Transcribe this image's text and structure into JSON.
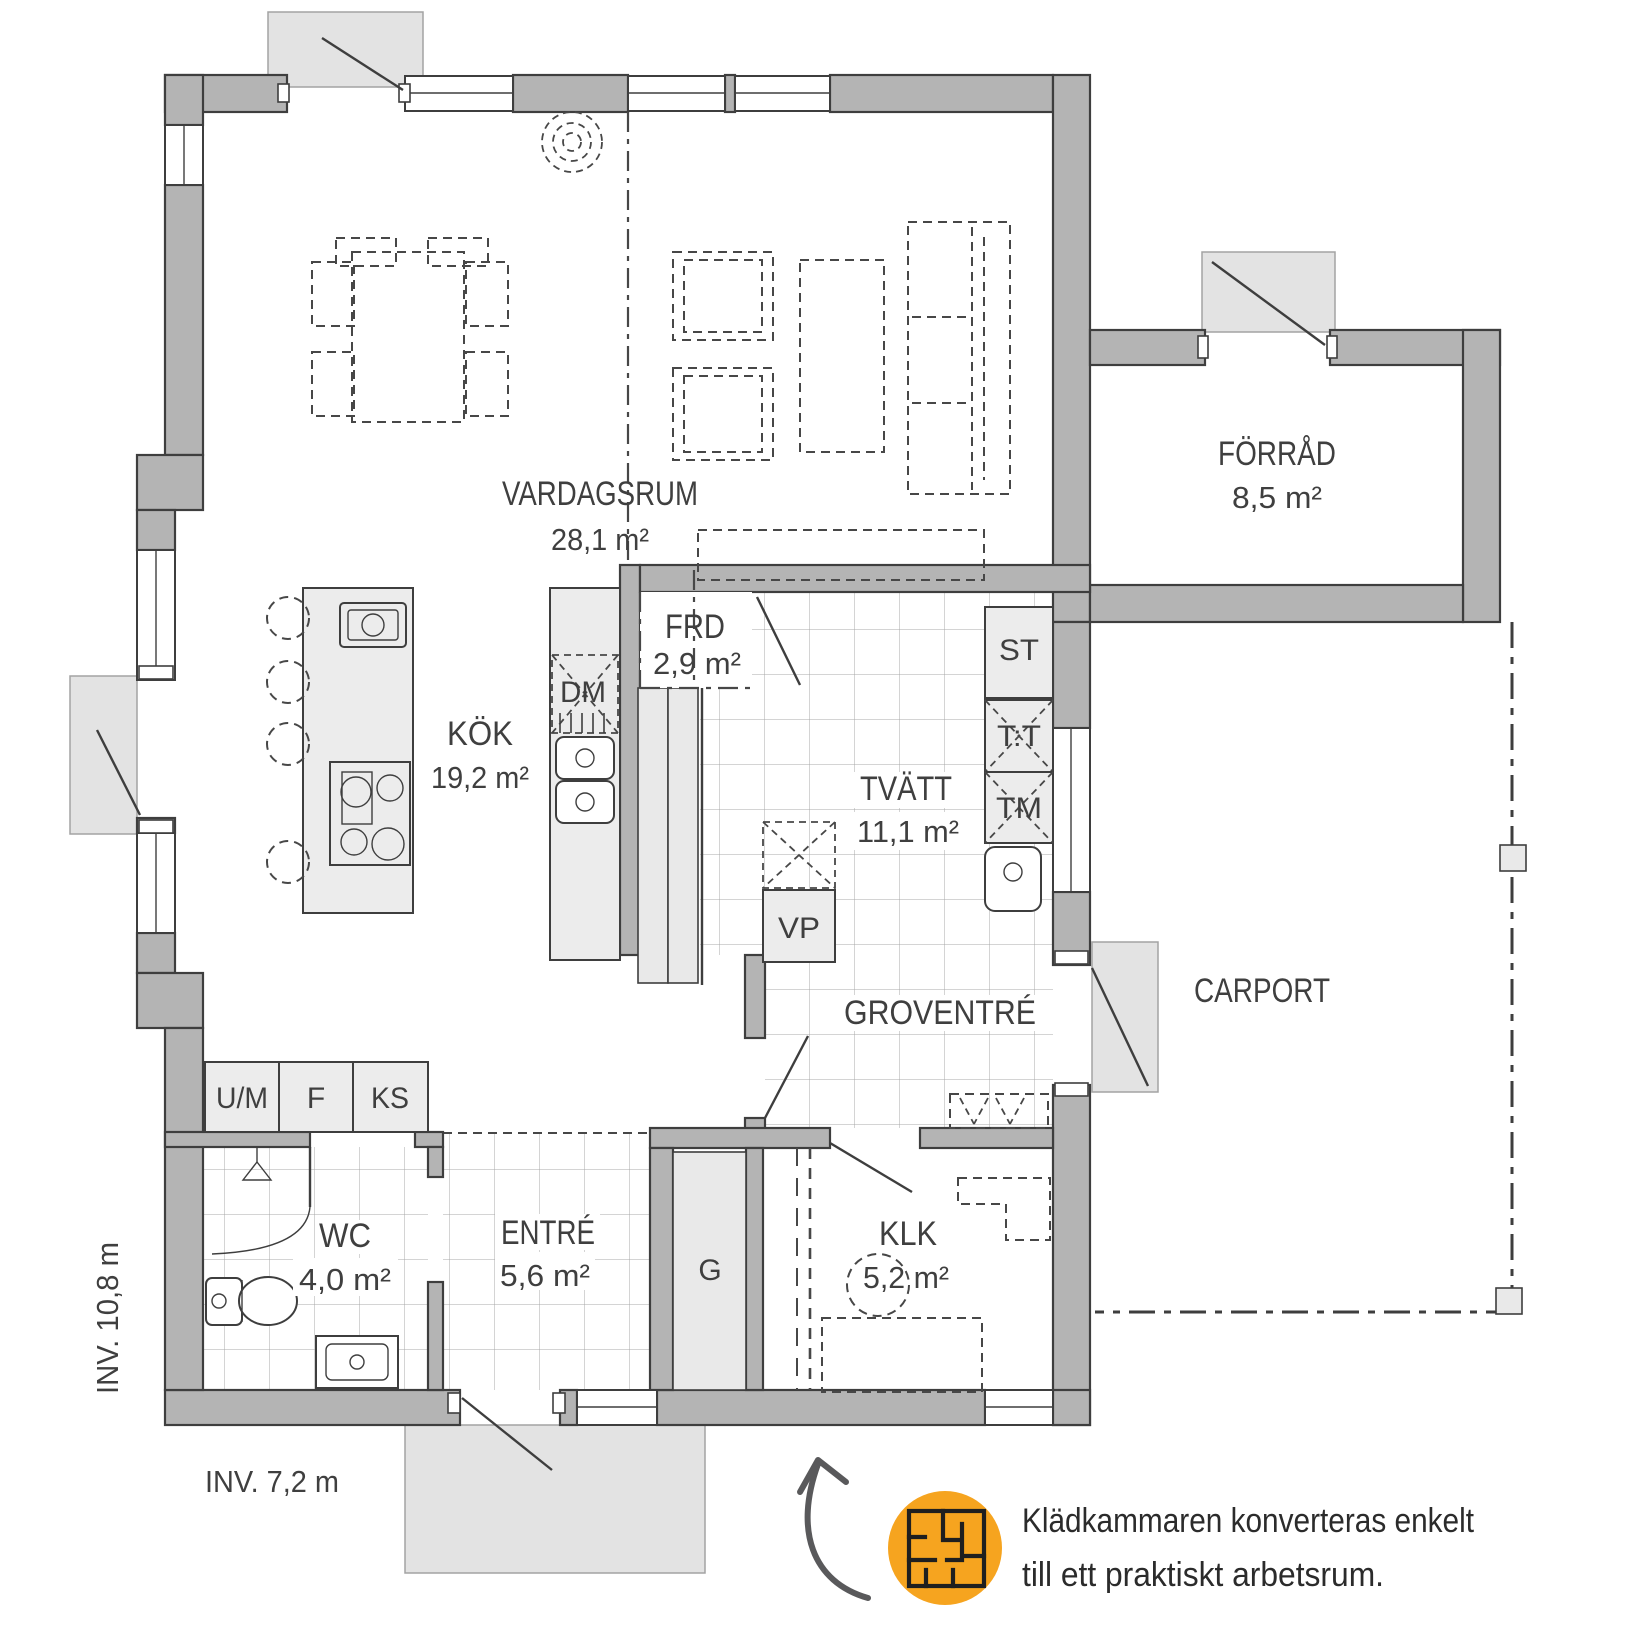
{
  "rooms": {
    "vardagsrum": {
      "name": "VARDAGSRUM",
      "area": "28,1 m²"
    },
    "kok": {
      "name": "KÖK",
      "area": "19,2 m²"
    },
    "forrad": {
      "name": "FÖRRÅD",
      "area": "8,5 m²"
    },
    "frd": {
      "name": "FRD",
      "area": "2,9 m²"
    },
    "tvatt": {
      "name": "TVÄTT",
      "area": "11,1 m²"
    },
    "groventre": {
      "name": "GROVENTRÉ"
    },
    "carport": {
      "name": "CARPORT"
    },
    "wc": {
      "name": "WC",
      "area": "4,0 m²"
    },
    "entre": {
      "name": "ENTRÉ",
      "area": "5,6 m²"
    },
    "klk": {
      "name": "KLK",
      "area": "5,2 m²"
    }
  },
  "fixtures": {
    "dm": "DM",
    "st": "ST",
    "tt": "T:T",
    "tm": "TM",
    "vp": "VP",
    "um": "U/M",
    "f": "F",
    "ks": "KS",
    "g": "G"
  },
  "dimensions": {
    "left": "INV. 10,8 m",
    "bottom": "INV. 7,2 m"
  },
  "annotation": {
    "line1": "Klädkammaren konverteras enkelt",
    "line2": "till ett praktiskt arbetsrum."
  },
  "colors": {
    "wall": "#b4b4b4",
    "outline": "#3e3e3e",
    "fixture": "#ececec",
    "pad": "#e3e3e3",
    "accent": "#f6a41f",
    "text": "#3f3f3f"
  }
}
